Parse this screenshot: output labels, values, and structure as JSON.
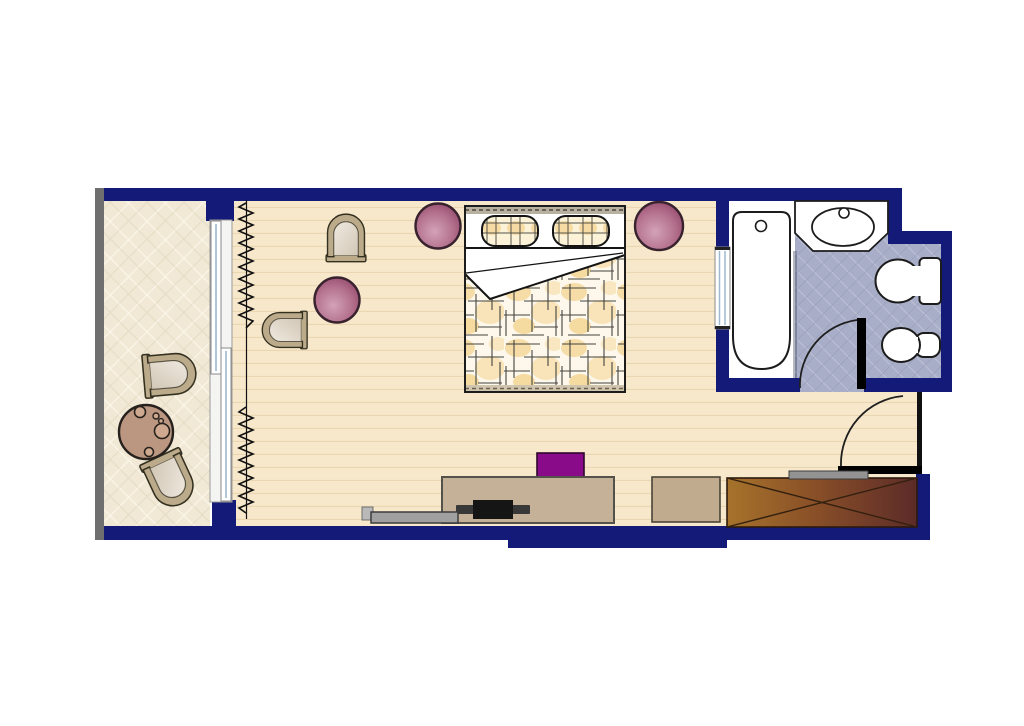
{
  "document": {
    "type": "hotel-room-floor-plan",
    "background": "#ffffff",
    "text_labels": []
  },
  "palette": {
    "wall": "#141a78",
    "wall_gray": "#6f6f6f",
    "outline": "#1c1c1c",
    "wood": "#f8e8cb",
    "wood_line": "#ead7b2",
    "balcony_tile": "#f1e9d5",
    "balcony_line": "#fbf6e9",
    "bath_tile": "#a9aec8",
    "bath_tile_light": "#c6cadd",
    "bath_tile_dark": "#9298b6",
    "fixture": "#ffffff",
    "glass": "#9db8cf",
    "chair_frame": "#bcab8a",
    "chair_stroke": "#343020",
    "cush_light": "#efe9df",
    "cush_dark": "#d2c7b6",
    "pouf_light": "#d3a2b8",
    "pouf_mid": "#b4718e",
    "pouf_dark": "#8e4265",
    "table": "#bb9680",
    "desk": "#c5b198",
    "dresser": "#c0ab8e",
    "bench": "#a0a0a0",
    "purple": "#8a0b8a",
    "wardrobe_light": "#a6732b",
    "wardrobe_mid": "#8a5028",
    "wardrobe_dark": "#5c2b28",
    "duvet_base": "#fdf8eb",
    "duvet_accent": "#f0c263",
    "pillow_base": "#fbf2d8",
    "door": "#000000",
    "headboard": "#b8b0a0"
  },
  "rooms": [
    {
      "id": "balcony",
      "floor": "diamond-tile"
    },
    {
      "id": "bedroom",
      "floor": "wood-plank"
    },
    {
      "id": "bathroom",
      "floor": "diagonal-tile"
    },
    {
      "id": "entry",
      "floor": "wood-plank"
    }
  ],
  "furniture": {
    "balcony": [
      "armchair-upper",
      "armchair-lower",
      "round-table-with-cups"
    ],
    "bedroom": [
      "curtain-upper",
      "curtain-lower",
      "sliding-glass-door",
      "armchair-by-window",
      "armchair-left",
      "pouf-left",
      "pouf-bedside-left",
      "pouf-bedside-right",
      "double-bed-with-plaid-duvet",
      "desk",
      "laptop",
      "desk-chair-purple",
      "media-bench"
    ],
    "bathroom": [
      "bathtub",
      "vanity-counter",
      "sink",
      "faucet",
      "toilet",
      "bidet",
      "interior-window",
      "bathroom-door"
    ],
    "entry": [
      "entrance-door",
      "wardrobe-crossed",
      "dresser",
      "luggage-shelf"
    ]
  }
}
